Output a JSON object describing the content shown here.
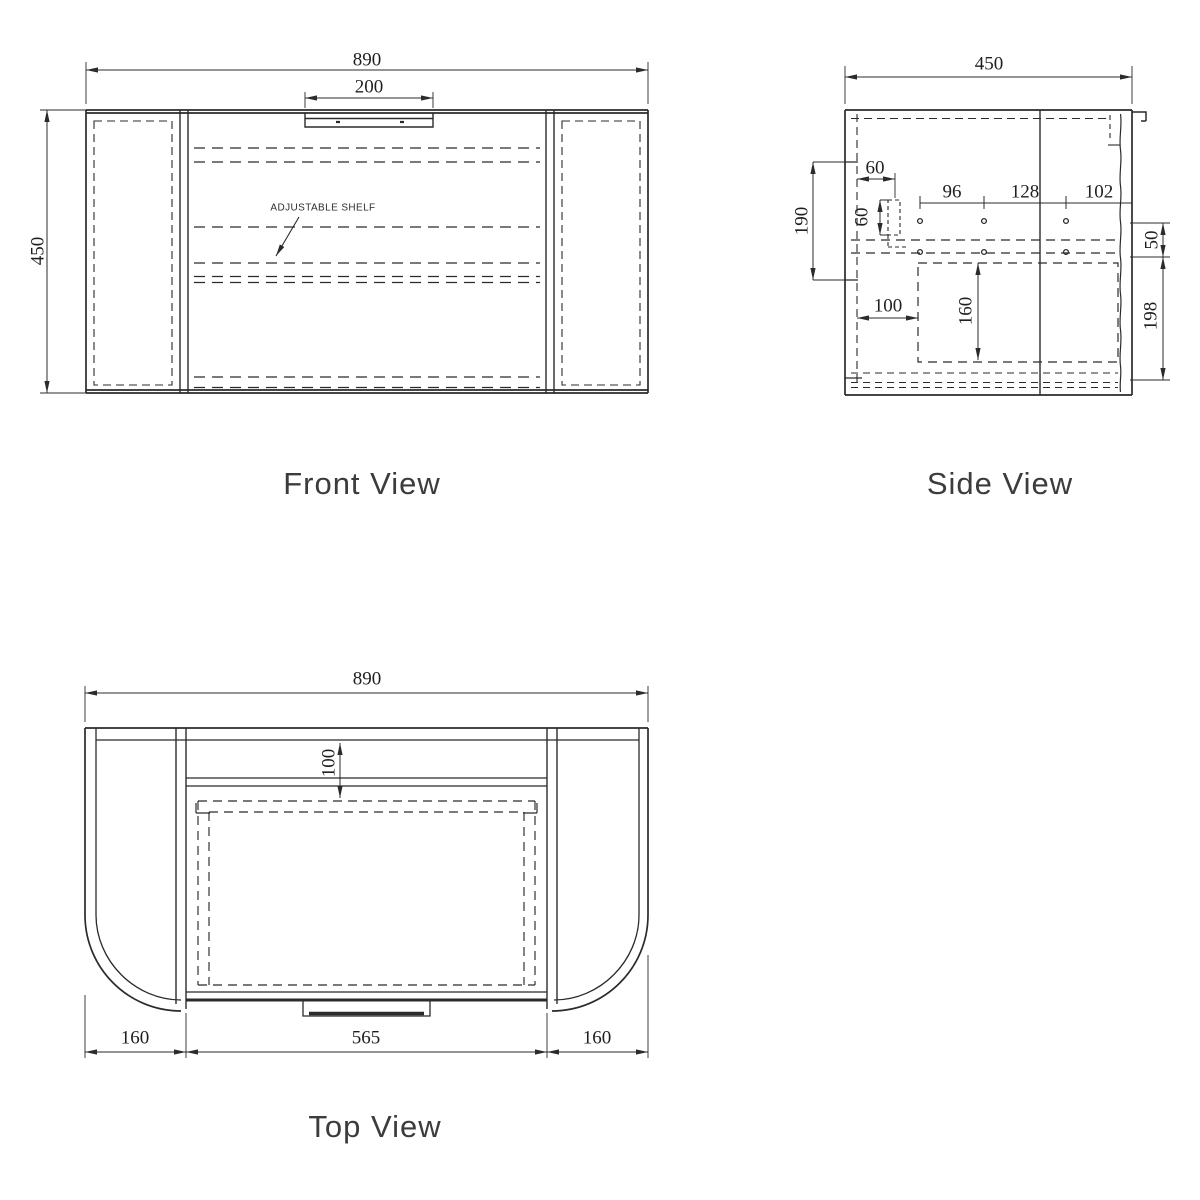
{
  "colors": {
    "line": "#2b2b2b",
    "dim_text": "#1f1f1f",
    "title_text": "#3c3c3c",
    "background": "#ffffff"
  },
  "front_view": {
    "title": "Front View",
    "overall_width": "890",
    "handle_width": "200",
    "overall_height": "450",
    "annotation": "ADJUSTABLE SHELF"
  },
  "side_view": {
    "title": "Side View",
    "overall_depth": "450",
    "hinge_offset_h": "60",
    "hinge_offset_v": "60",
    "hole_pitch_a": "96",
    "hole_pitch_b": "128",
    "hole_pitch_c": "102",
    "front_zone": "190",
    "row_gap": "50",
    "lower_gap": "198",
    "drawer_inset": "100",
    "cutout_height": "160"
  },
  "top_view": {
    "title": "Top View",
    "overall_width": "890",
    "rail_depth": "100",
    "left_wing": "160",
    "center_width": "565",
    "right_wing": "160"
  }
}
